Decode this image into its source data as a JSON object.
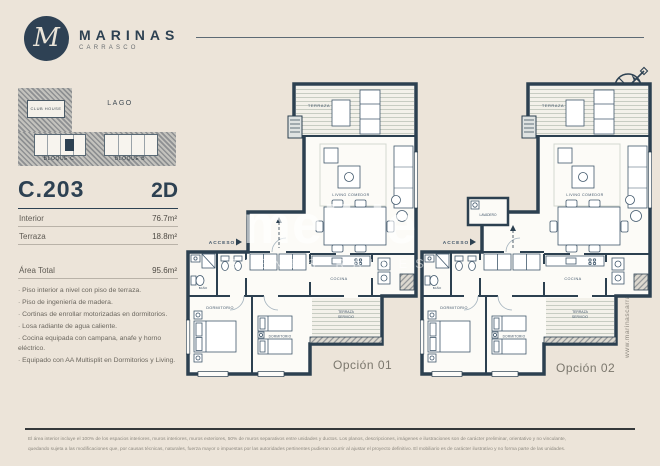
{
  "brand": {
    "initial": "M",
    "name": "MARINAS",
    "sub": "CARRASCO"
  },
  "site_map": {
    "lago": "LAGO",
    "club_house": "CLUB HOUSE",
    "bloque_c": "BLOQUE C",
    "bloque_b": "BLOQUE B"
  },
  "unit": {
    "code": "C.203",
    "type": "2D",
    "rows": [
      {
        "label": "Interior",
        "value": "76.7m²"
      },
      {
        "label": "Terraza",
        "value": "18.8m²"
      }
    ],
    "total_label": "Área Total",
    "total_value": "95.6m²"
  },
  "features": [
    "· Piso interior a nivel con piso de terraza.",
    "· Piso de ingeniería de madera.",
    "· Cortinas de enrollar motorizadas en dormitorios.",
    "· Losa radiante de agua caliente.",
    "· Cocina equipada con campana, anafe y horno eléctrico.",
    "· Equipado con AA Multisplit en Dormitorios y Living."
  ],
  "plans": [
    {
      "name": "Opción 01",
      "labels": {
        "terraza": "TERRAZA",
        "living": "LIVING COMEDOR",
        "cocina": "COCINA",
        "acceso": "ACCESO",
        "dorm1": "DORMITORIO",
        "dorm2": "DORMITORIO",
        "bano": "BAÑO",
        "terraza_s1": "TERRAZA",
        "terraza_s2": "SERVICIO"
      }
    },
    {
      "name": "Opción 02",
      "labels": {
        "terraza": "TERRAZA",
        "living": "LIVING COMEDOR",
        "cocina": "COCINA",
        "acceso": "ACCESO",
        "dorm1": "DORMITORIO",
        "dorm2": "DORMITORIO",
        "bano": "BAÑO",
        "terraza_s1": "TERRAZA",
        "terraza_s2": "SERVICIO",
        "lavadero": "LAVADERO"
      }
    }
  ],
  "watermark": {
    "word": "meikle",
    "sub": "BIENES RAICES"
  },
  "website": "www.marinascarrasco.com",
  "colors": {
    "navy": "#2d4152",
    "cream": "#ece4d9"
  },
  "disclaimer": {
    "line1": "El área interior incluye el 100% de los espacios interiores, muros interiores, muros exteriores, 50% de muros separativos entre unidades y ductos. Los planos, descripciones, imágenes e ilustraciones son de carácter preliminar, orientativo y no vinculante,",
    "line2": "quedando sujeta a las modificaciones que, por causas técnicas, naturales, fuerza mayor o impuestas por las autoridades pertinentes pudieran ocurrir al ajustar el proyecto definitivo. El mobiliario es de carácter ilustrativo y no forma parte de las unidades."
  }
}
